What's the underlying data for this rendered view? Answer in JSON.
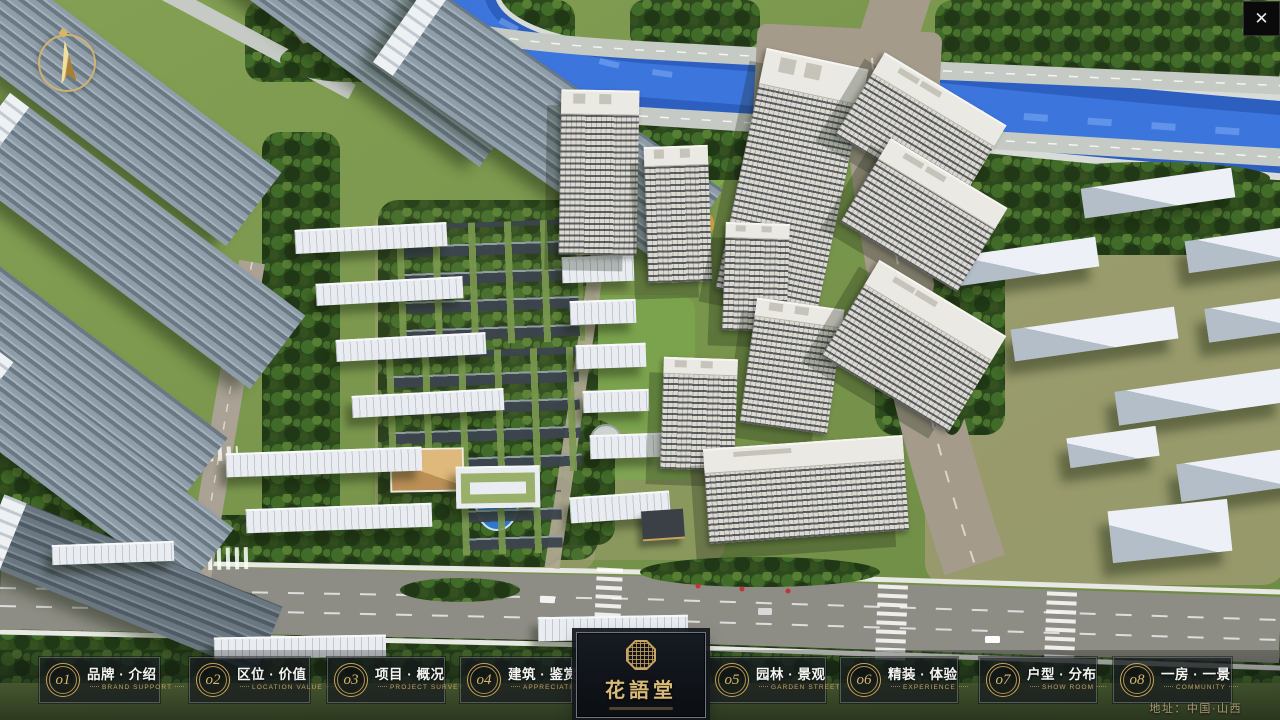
{
  "icons": {
    "close": "✕",
    "compass": "north-arrow",
    "logo_seal": "octagonal-seal"
  },
  "nav": {
    "items": [
      {
        "num": "o1",
        "cn": "品牌 · 介绍",
        "en": "BRAND SUPPORT"
      },
      {
        "num": "o2",
        "cn": "区位 · 价值",
        "en": "LOCATION VALUE"
      },
      {
        "num": "o3",
        "cn": "项目 · 概况",
        "en": "PROJECT SURVEY"
      },
      {
        "num": "o4",
        "cn": "建筑 · 鉴赏",
        "en": "APPRECIATION"
      },
      {
        "num": "o5",
        "cn": "园林 · 景观",
        "en": "GARDEN STREET"
      },
      {
        "num": "o6",
        "cn": "精装 · 体验",
        "en": "EXPERIENCE"
      },
      {
        "num": "o7",
        "cn": "户型 · 分布",
        "en": "SHOW ROOM"
      },
      {
        "num": "o8",
        "cn": "一房 · 一景",
        "en": "COMMUNITY"
      }
    ],
    "logo_title": "花語堂",
    "address": "地址：中国·山西"
  },
  "colors": {
    "accent_gold": "#c8a55e",
    "river_blue": "#2e63c4",
    "bar_bg": "rgba(16,20,24,0.72)"
  }
}
